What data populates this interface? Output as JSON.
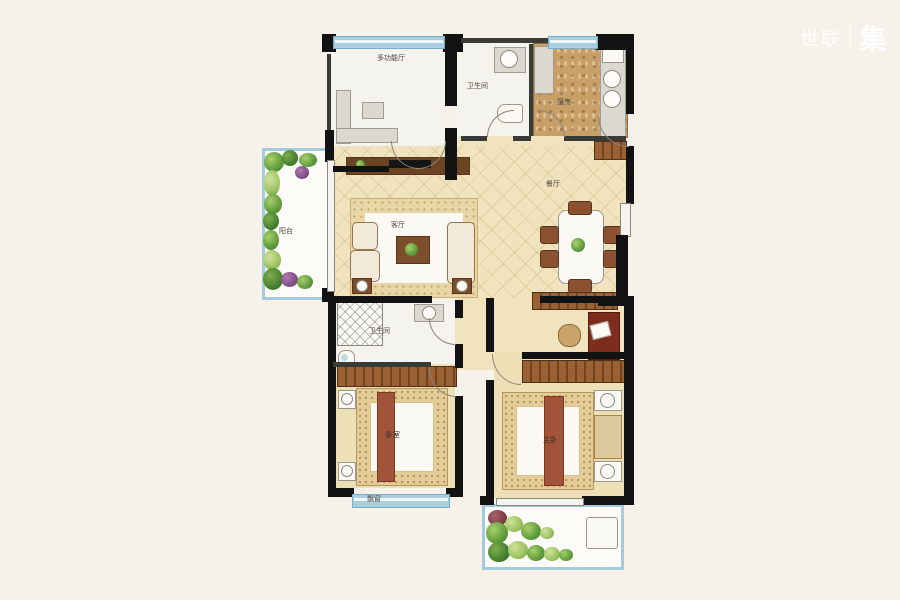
{
  "logo": {
    "brand": "世联",
    "suffix": "集"
  },
  "rooms": {
    "multi": {
      "label": "多功能厅"
    },
    "bath_top": {
      "label": "卫生间"
    },
    "kitchen": {
      "label": "厨房"
    },
    "living": {
      "label": "客厅"
    },
    "dining": {
      "label": "餐厅"
    },
    "balcony_left": {
      "label": "阳台"
    },
    "bath_mid": {
      "label": "卫生间"
    },
    "bedroom_left": {
      "label": "卧室"
    },
    "bedroom_right": {
      "label": "主卧"
    },
    "bay_window": {
      "label": "飘窗"
    }
  },
  "colors": {
    "background_cream": "#f7f2e9",
    "wall_black": "#121212",
    "window_blue": "#a9cede",
    "floor_beige": "#f0e3bd",
    "kitchen_tan": "#c89f66",
    "wood_brown": "#7d4e2a",
    "bed_runner_maroon": "#a1543a",
    "plant_green": "#5f9b3c"
  }
}
